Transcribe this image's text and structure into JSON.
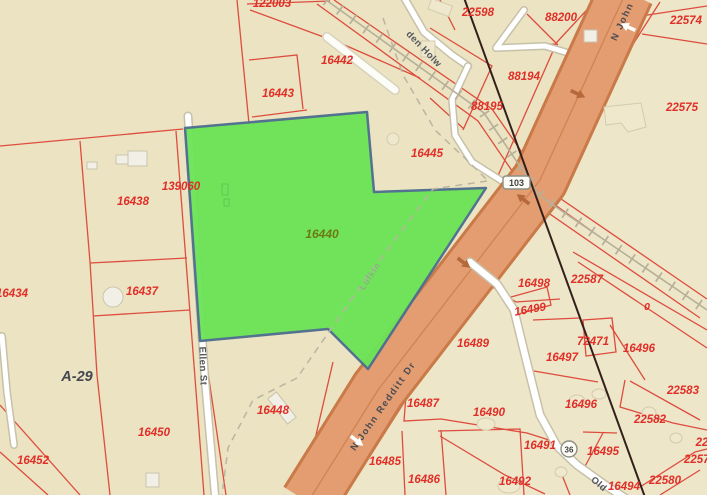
{
  "map": {
    "selected_parcel_id": "16440",
    "colors": {
      "background": "#ebe3c1",
      "background_east": "#f1ead0",
      "parcel_line": "#dd4437",
      "selected_fill": "#6ce457",
      "selected_stroke": "#4d6e8f",
      "parcel_label": "#e02e28",
      "selected_label": "#6c7a15",
      "road_fill": "#e49d70",
      "road_casing": "#c97a48",
      "minor_road": "#ffffff",
      "minor_road_casing": "#c6c1a9",
      "railroad": "#b6b099",
      "city_boundary_dash": "#b9b5a2",
      "utility_line": "#33201c"
    },
    "parcels": {
      "p122003": "122003",
      "p22598": "22598",
      "p88200": "88200",
      "p22574": "22574",
      "p16442": "16442",
      "p88194": "88194",
      "p88195": "88195",
      "p16443": "16443",
      "p22575": "22575",
      "p16445": "16445",
      "p139060": "139060",
      "p16438": "16438",
      "p16440": "16440",
      "p16434": "16434",
      "p16437": "16437",
      "p16498": "16498",
      "p22587": "22587",
      "p16499": "16499",
      "p0": "0",
      "p16489": "16489",
      "p72471": "72471",
      "p16496a": "16496",
      "p16497": "16497",
      "p16450": "16450",
      "p16452": "16452",
      "p16448": "16448",
      "p16487": "16487",
      "p16485": "16485",
      "p16486": "16486",
      "p16490": "16490",
      "p16496b": "16496",
      "p22583": "22583",
      "p22582": "22582",
      "p16491": "16491",
      "p16495": "16495",
      "p16492": "16492",
      "p16494": "16494",
      "p22580": "22580",
      "p22579": "22579",
      "p22x": "22"
    },
    "streets": {
      "den_holw": "den Holw",
      "ellen_st": "Ellen St",
      "n_john_redditt_dr": "N John Redditt Dr",
      "old_road": "Old",
      "lufkin_boundary": "Lufkin"
    },
    "survey": {
      "abstract": "A-29"
    },
    "shields": {
      "sh103": "103",
      "sh36": "36"
    }
  }
}
